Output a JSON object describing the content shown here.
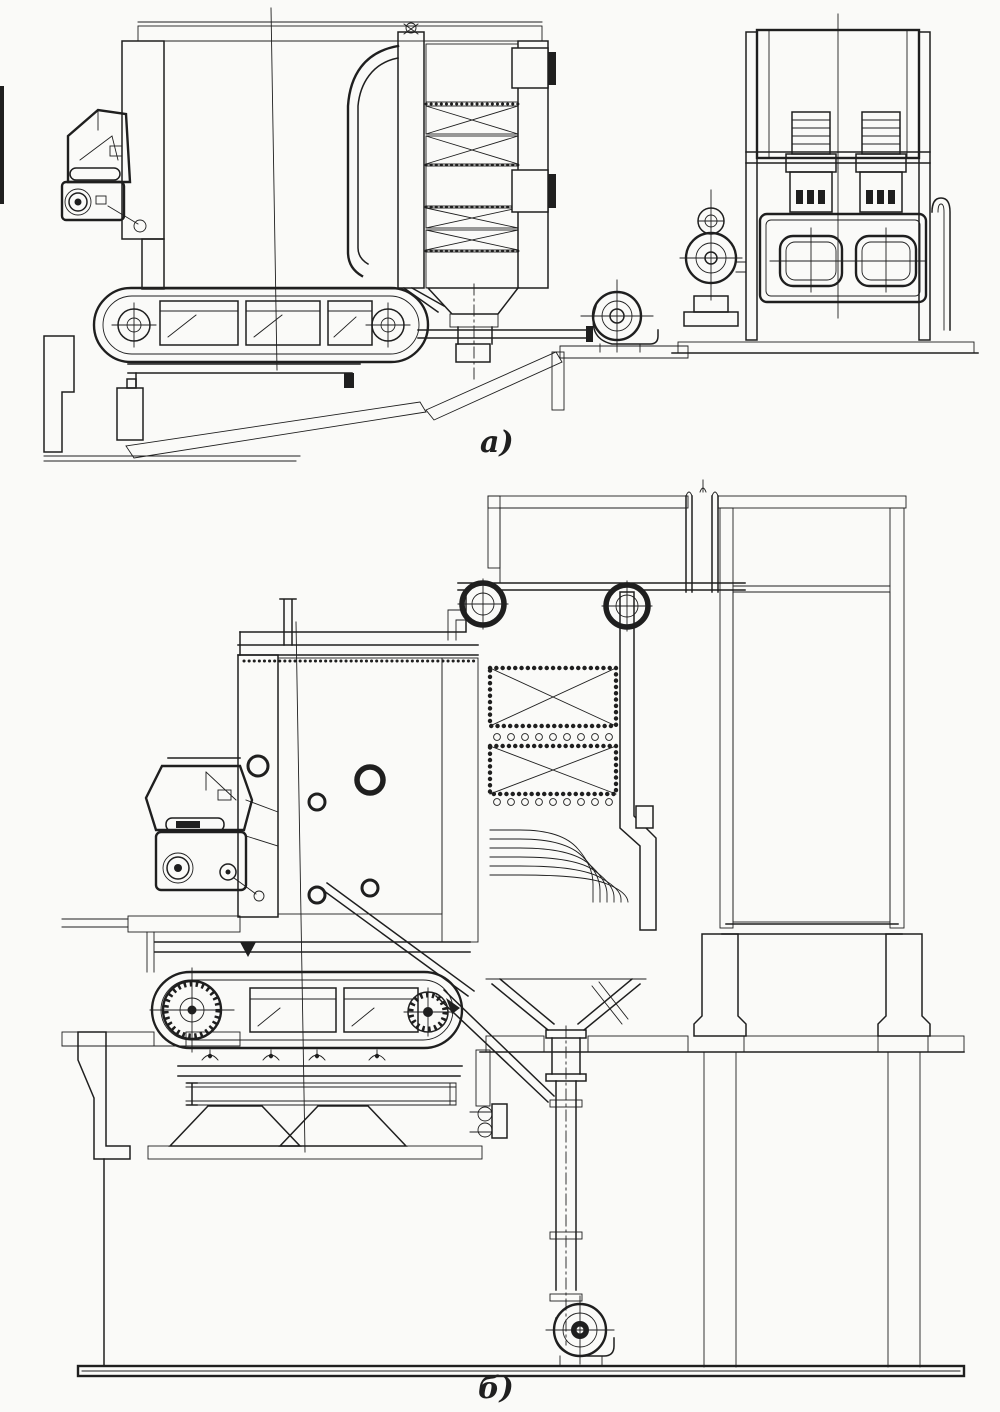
{
  "canvas": {
    "width": 1000,
    "height": 1412,
    "paper": "#fafaf8",
    "ink": "#1f1f1f"
  },
  "figures": [
    {
      "id": "fig-a",
      "caption": "а)"
    },
    {
      "id": "fig-b",
      "caption": "б)"
    }
  ]
}
